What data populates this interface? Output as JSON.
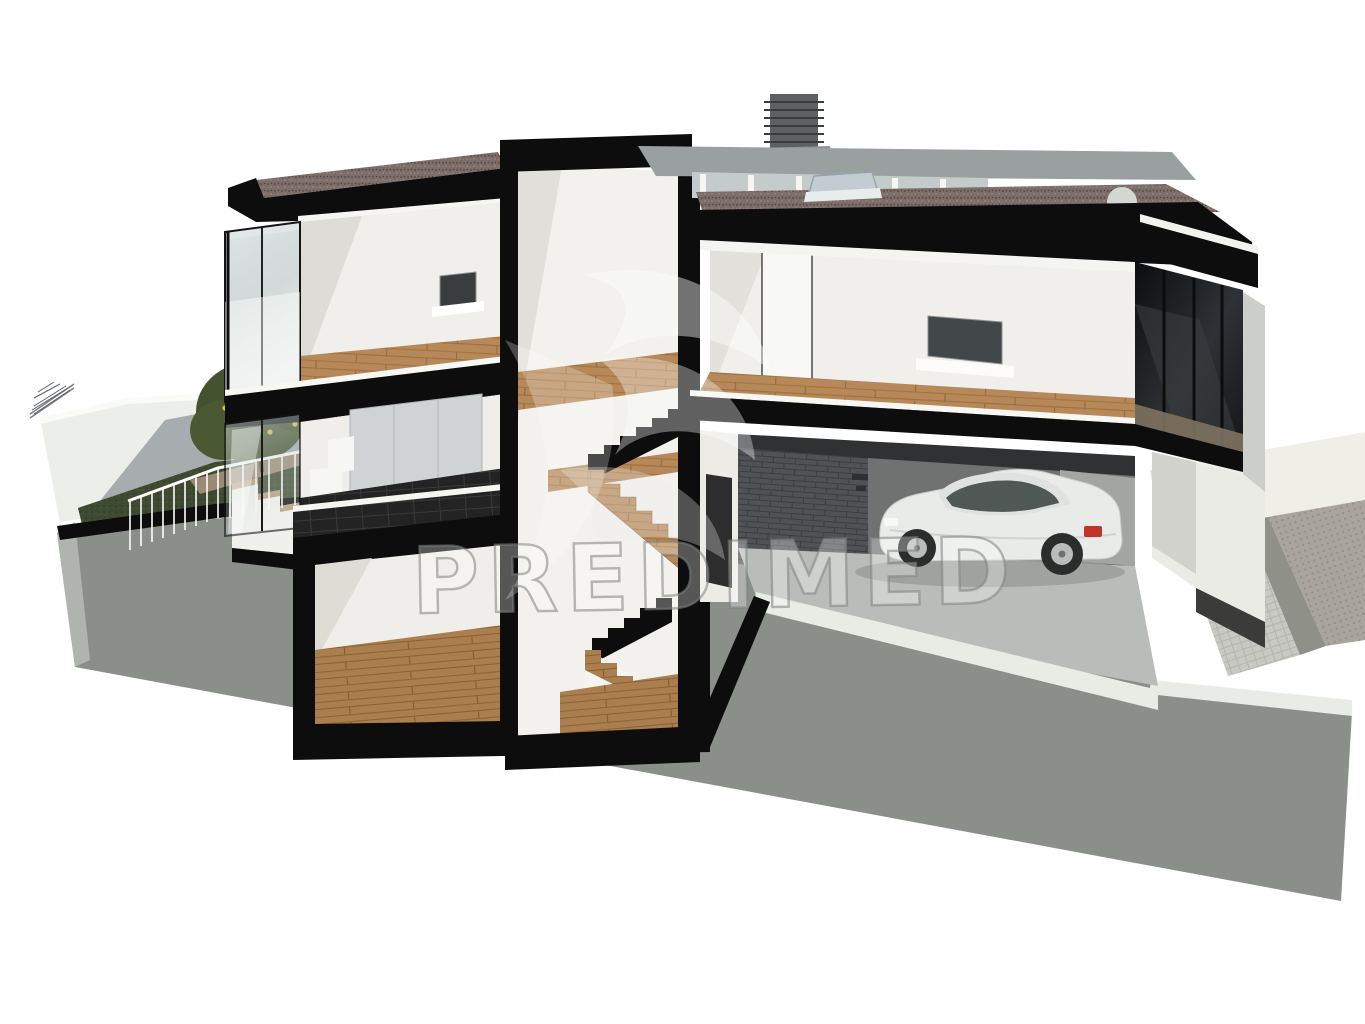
{
  "watermark": {
    "text": "PREDIMED",
    "logo_icon": "leaf-swirl-icon"
  },
  "scene": {
    "kind": "3D cutaway section render of a modern two-storey villa with basement and garage",
    "elements": [
      "flat-gravel-roof",
      "chimney-with-louvers",
      "roof-skylight",
      "roof-dome-vent",
      "clerestory-windows",
      "stair-tower",
      "upper-bedroom-with-tv",
      "upper-living-room-with-tv",
      "glass-balcony",
      "ground-floor-glass-wall",
      "wardrobe-wall",
      "dark-tile-terrace",
      "basement-room",
      "switchback-wood-stairs",
      "garage-with-white-coupe-car",
      "brick-garage-wall",
      "garden-lawn",
      "fruit-tree",
      "white-boundary-wall",
      "garden-railing",
      "outdoor-steps",
      "wood-deck-path",
      "paved-driveway",
      "cut-earth-ground"
    ]
  },
  "palette": {
    "background": "#ffffff",
    "cut_outline_black": "#0d0d0d",
    "wall_white": "#f0efeb",
    "ground_gray": "#8a8f8a",
    "grass_green": "#3e4a31",
    "wood_floor": "#b7895a",
    "roof_gravel": "#7c6d69",
    "roof_gray": "#9aa0a0",
    "dark_glass": "#17191b",
    "garage_brick": "#4f5355",
    "garage_floor": "#b9bdb9",
    "car_body": "#e9ebe9",
    "car_glass": "#47504c",
    "taillight_red": "#c23428",
    "driveway_paver": "#a9a59d",
    "apron_cream": "#f0efe7",
    "watermark_gray": "#8a8f8f"
  }
}
